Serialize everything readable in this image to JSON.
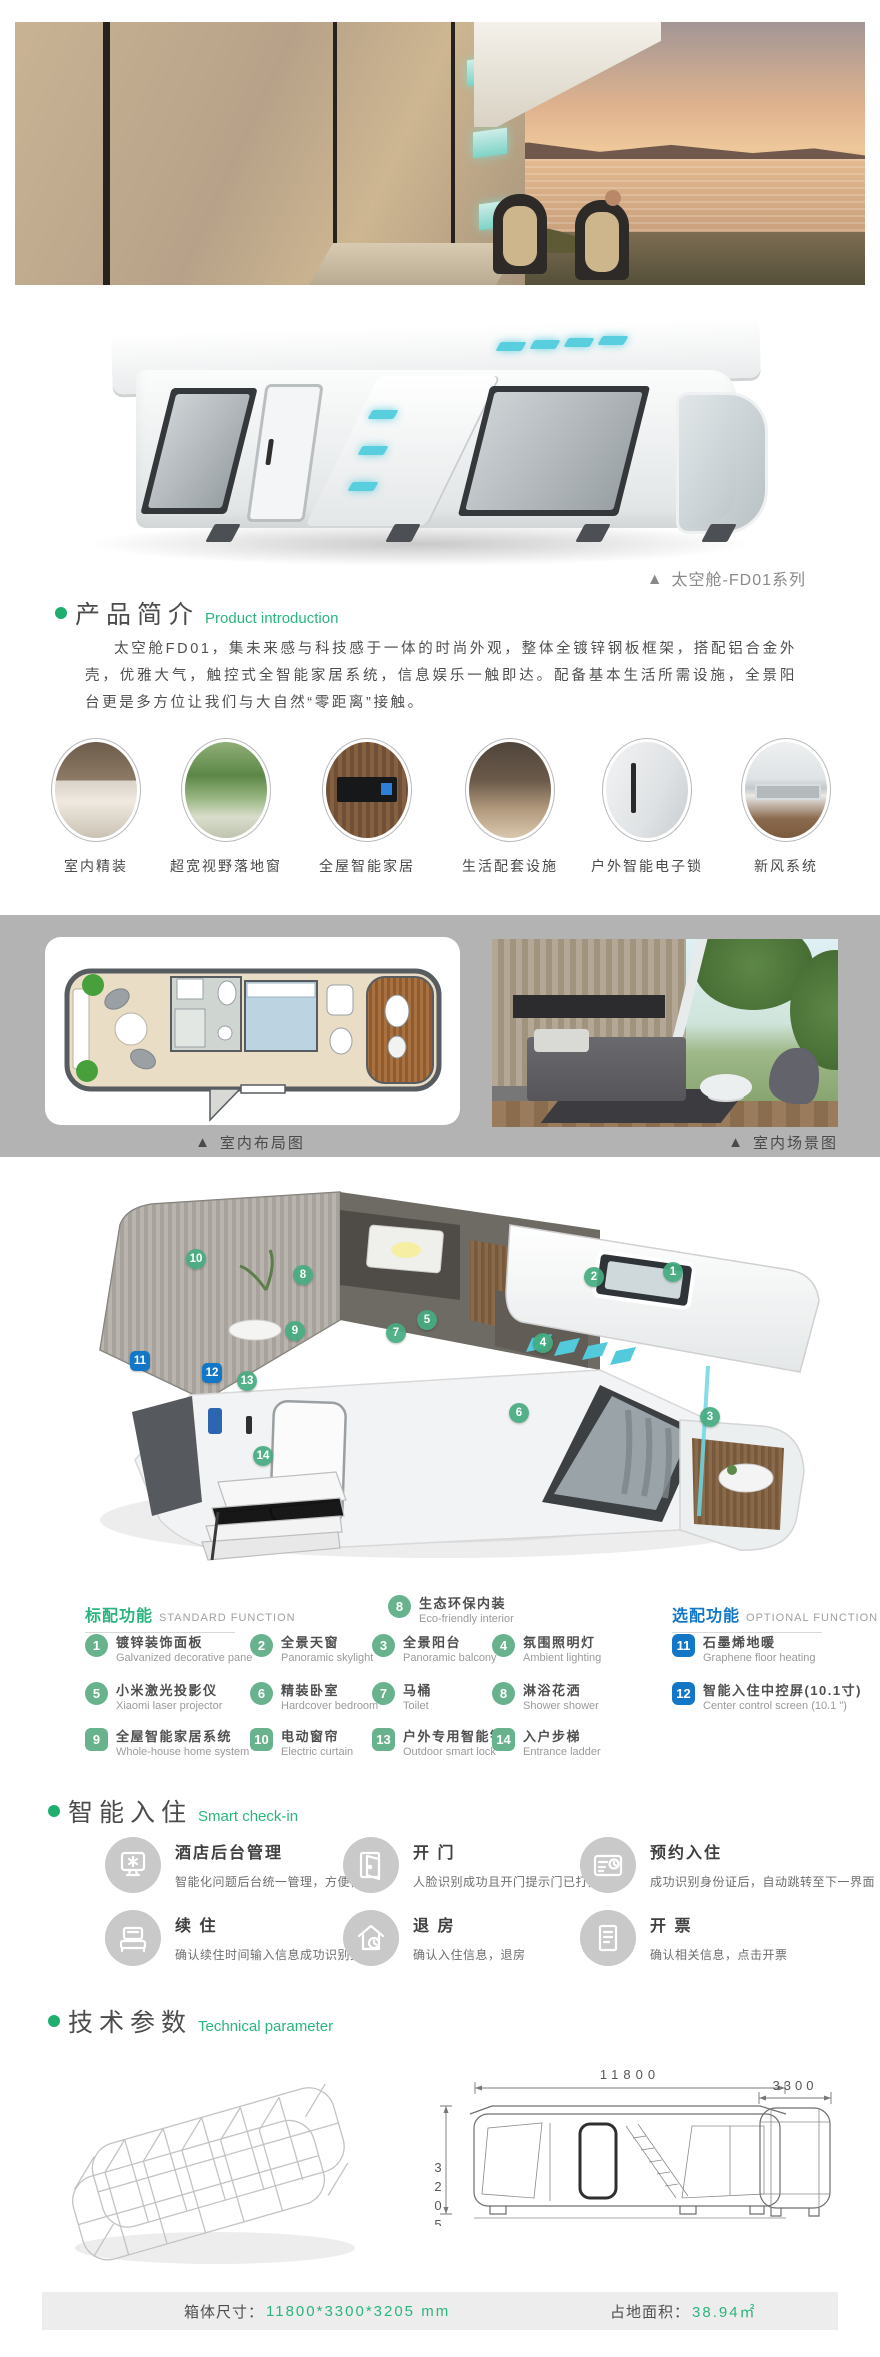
{
  "ui": {
    "triangle": "▲"
  },
  "colors": {
    "accent_green": "#2bb57e",
    "badge_green": "#68b38e",
    "badge_blue": "#1377c8",
    "band_gray": "#b3b3b3",
    "footer_gray": "#ededed"
  },
  "series_caption": "太空舱-FD01系列",
  "intro": {
    "title_zh": "产品简介",
    "title_en": "Product introduction",
    "paragraph": "太空舱FD01，集未来感与科技感于一体的时尚外观，整体全镀锌钢板框架，搭配铝合金外壳，优雅大气，触控式全智能家居系统，信息娱乐一触即达。配备基本生活所需设施，全景阳台更是多方位让我们与大自然“零距离”接触。"
  },
  "features": [
    {
      "label": "室内精装"
    },
    {
      "label": "超宽视野落地窗"
    },
    {
      "label": "全屋智能家居"
    },
    {
      "label": "生活配套设施"
    },
    {
      "label": "户外智能电子锁"
    },
    {
      "label": "新风系统"
    }
  ],
  "gallery": {
    "caption_left": "室内布局图",
    "caption_right": "室内场景图"
  },
  "diagram": {
    "callouts": [
      {
        "n": "1"
      },
      {
        "n": "2"
      },
      {
        "n": "3"
      },
      {
        "n": "4"
      },
      {
        "n": "5"
      },
      {
        "n": "6"
      },
      {
        "n": "7"
      },
      {
        "n": "8"
      },
      {
        "n": "9"
      },
      {
        "n": "10"
      },
      {
        "n": "11",
        "optional": true
      },
      {
        "n": "12",
        "optional": true
      },
      {
        "n": "13"
      },
      {
        "n": "14"
      }
    ]
  },
  "functions": {
    "standard_header_zh": "标配功能",
    "standard_header_en": "STANDARD FUNCTION",
    "optional_header_zh": "选配功能",
    "optional_header_en": "OPTIONAL FUNCTION",
    "top_item": {
      "num": "8",
      "zh": "生态环保内装",
      "en": "Eco-friendly interior"
    },
    "standard": [
      {
        "num": "1",
        "zh": "镀锌装饰面板",
        "en": "Galvanized decorative pane"
      },
      {
        "num": "2",
        "zh": "全景天窗",
        "en": "Panoramic skylight"
      },
      {
        "num": "3",
        "zh": "全景阳台",
        "en": "Panoramic balcony"
      },
      {
        "num": "4",
        "zh": "氛围照明灯",
        "en": "Ambient lighting"
      },
      {
        "num": "5",
        "zh": "小米激光投影仪",
        "en": "Xiaomi laser projector"
      },
      {
        "num": "6",
        "zh": "精装卧室",
        "en": "Hardcover bedroom"
      },
      {
        "num": "7",
        "zh": "马桶",
        "en": "Toilet"
      },
      {
        "num": "8",
        "zh": "淋浴花洒",
        "en": "Shower shower"
      },
      {
        "num": "9",
        "zh": "全屋智能家居系统",
        "en": "Whole-house home system"
      },
      {
        "num": "10",
        "zh": "电动窗帘",
        "en": "Electric curtain"
      },
      {
        "num": "13",
        "zh": "户外专用智能锁",
        "en": "Outdoor smart lock"
      },
      {
        "num": "14",
        "zh": "入户步梯",
        "en": "Entrance ladder"
      }
    ],
    "optional": [
      {
        "num": "11",
        "zh": "石墨烯地暖",
        "en": "Graphene floor heating"
      },
      {
        "num": "12",
        "zh": "智能入住中控屏(10.1寸)",
        "en": "Center control screen (10.1 \")"
      }
    ]
  },
  "checkin": {
    "title_zh": "智能入住",
    "title_en": "Smart check-in",
    "items": [
      {
        "title": "酒店后台管理",
        "desc": "智能化问题后台统一管理，方便快捷",
        "icon": "kiosk-icon"
      },
      {
        "title": "开 门",
        "desc": "人脸识别成功且开门提示门已打开",
        "icon": "door-icon"
      },
      {
        "title": "预约入住",
        "desc": "成功识别身份证后，自动跳转至下一界面",
        "icon": "id-card-icon"
      },
      {
        "title": "续 住",
        "desc": "确认续住时间输入信息成功识别身份",
        "icon": "bed-icon"
      },
      {
        "title": "退 房",
        "desc": "确认入住信息，退房",
        "icon": "house-clock-icon"
      },
      {
        "title": "开 票",
        "desc": "确认相关信息，点击开票",
        "icon": "invoice-icon"
      }
    ]
  },
  "tech": {
    "title_zh": "技术参数",
    "title_en": "Technical parameter",
    "dim_length": "11800",
    "dim_width": "3300",
    "dim_height": "3205"
  },
  "footer": {
    "size_label": "箱体尺寸：",
    "size_value": "11800*3300*3205 mm",
    "area_label": "占地面积：",
    "area_value": "38.94㎡"
  }
}
